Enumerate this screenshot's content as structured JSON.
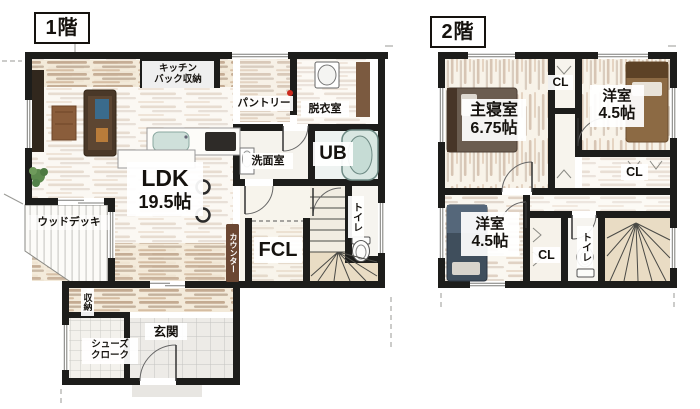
{
  "colors": {
    "wall": "#1d1d1b",
    "wood_light": "#c9a87f",
    "wood_dark": "#8a5f3b",
    "bath_teal": "#cfe3dd",
    "marker_red": "#cc2a1e",
    "tick_gray": "#9a9a96"
  },
  "floor1": {
    "title": "1階",
    "rooms": {
      "kitchen_back": "キッチン\nバック収納",
      "pantry": "パントリー",
      "dressing": "脱衣室",
      "washroom": "洗面室",
      "bath": "UB",
      "ldk_name": "LDK",
      "ldk_size": "19.5帖",
      "counter": "カウンター",
      "fcl": "FCL",
      "toilet": "トイレ",
      "wood_deck": "ウッドデッキ",
      "storage": "収納",
      "entrance": "玄関",
      "shoe_closet": "シューズ\nクローク"
    }
  },
  "floor2": {
    "title": "2階",
    "rooms": {
      "master_name": "主寝室",
      "master_size": "6.75帖",
      "closet1": "CL",
      "bedroom1_name": "洋室",
      "bedroom1_size": "4.5帖",
      "closet2": "CL",
      "bedroom2_name": "洋室",
      "bedroom2_size": "4.5帖",
      "closet3": "CL",
      "toilet": "トイレ"
    }
  }
}
